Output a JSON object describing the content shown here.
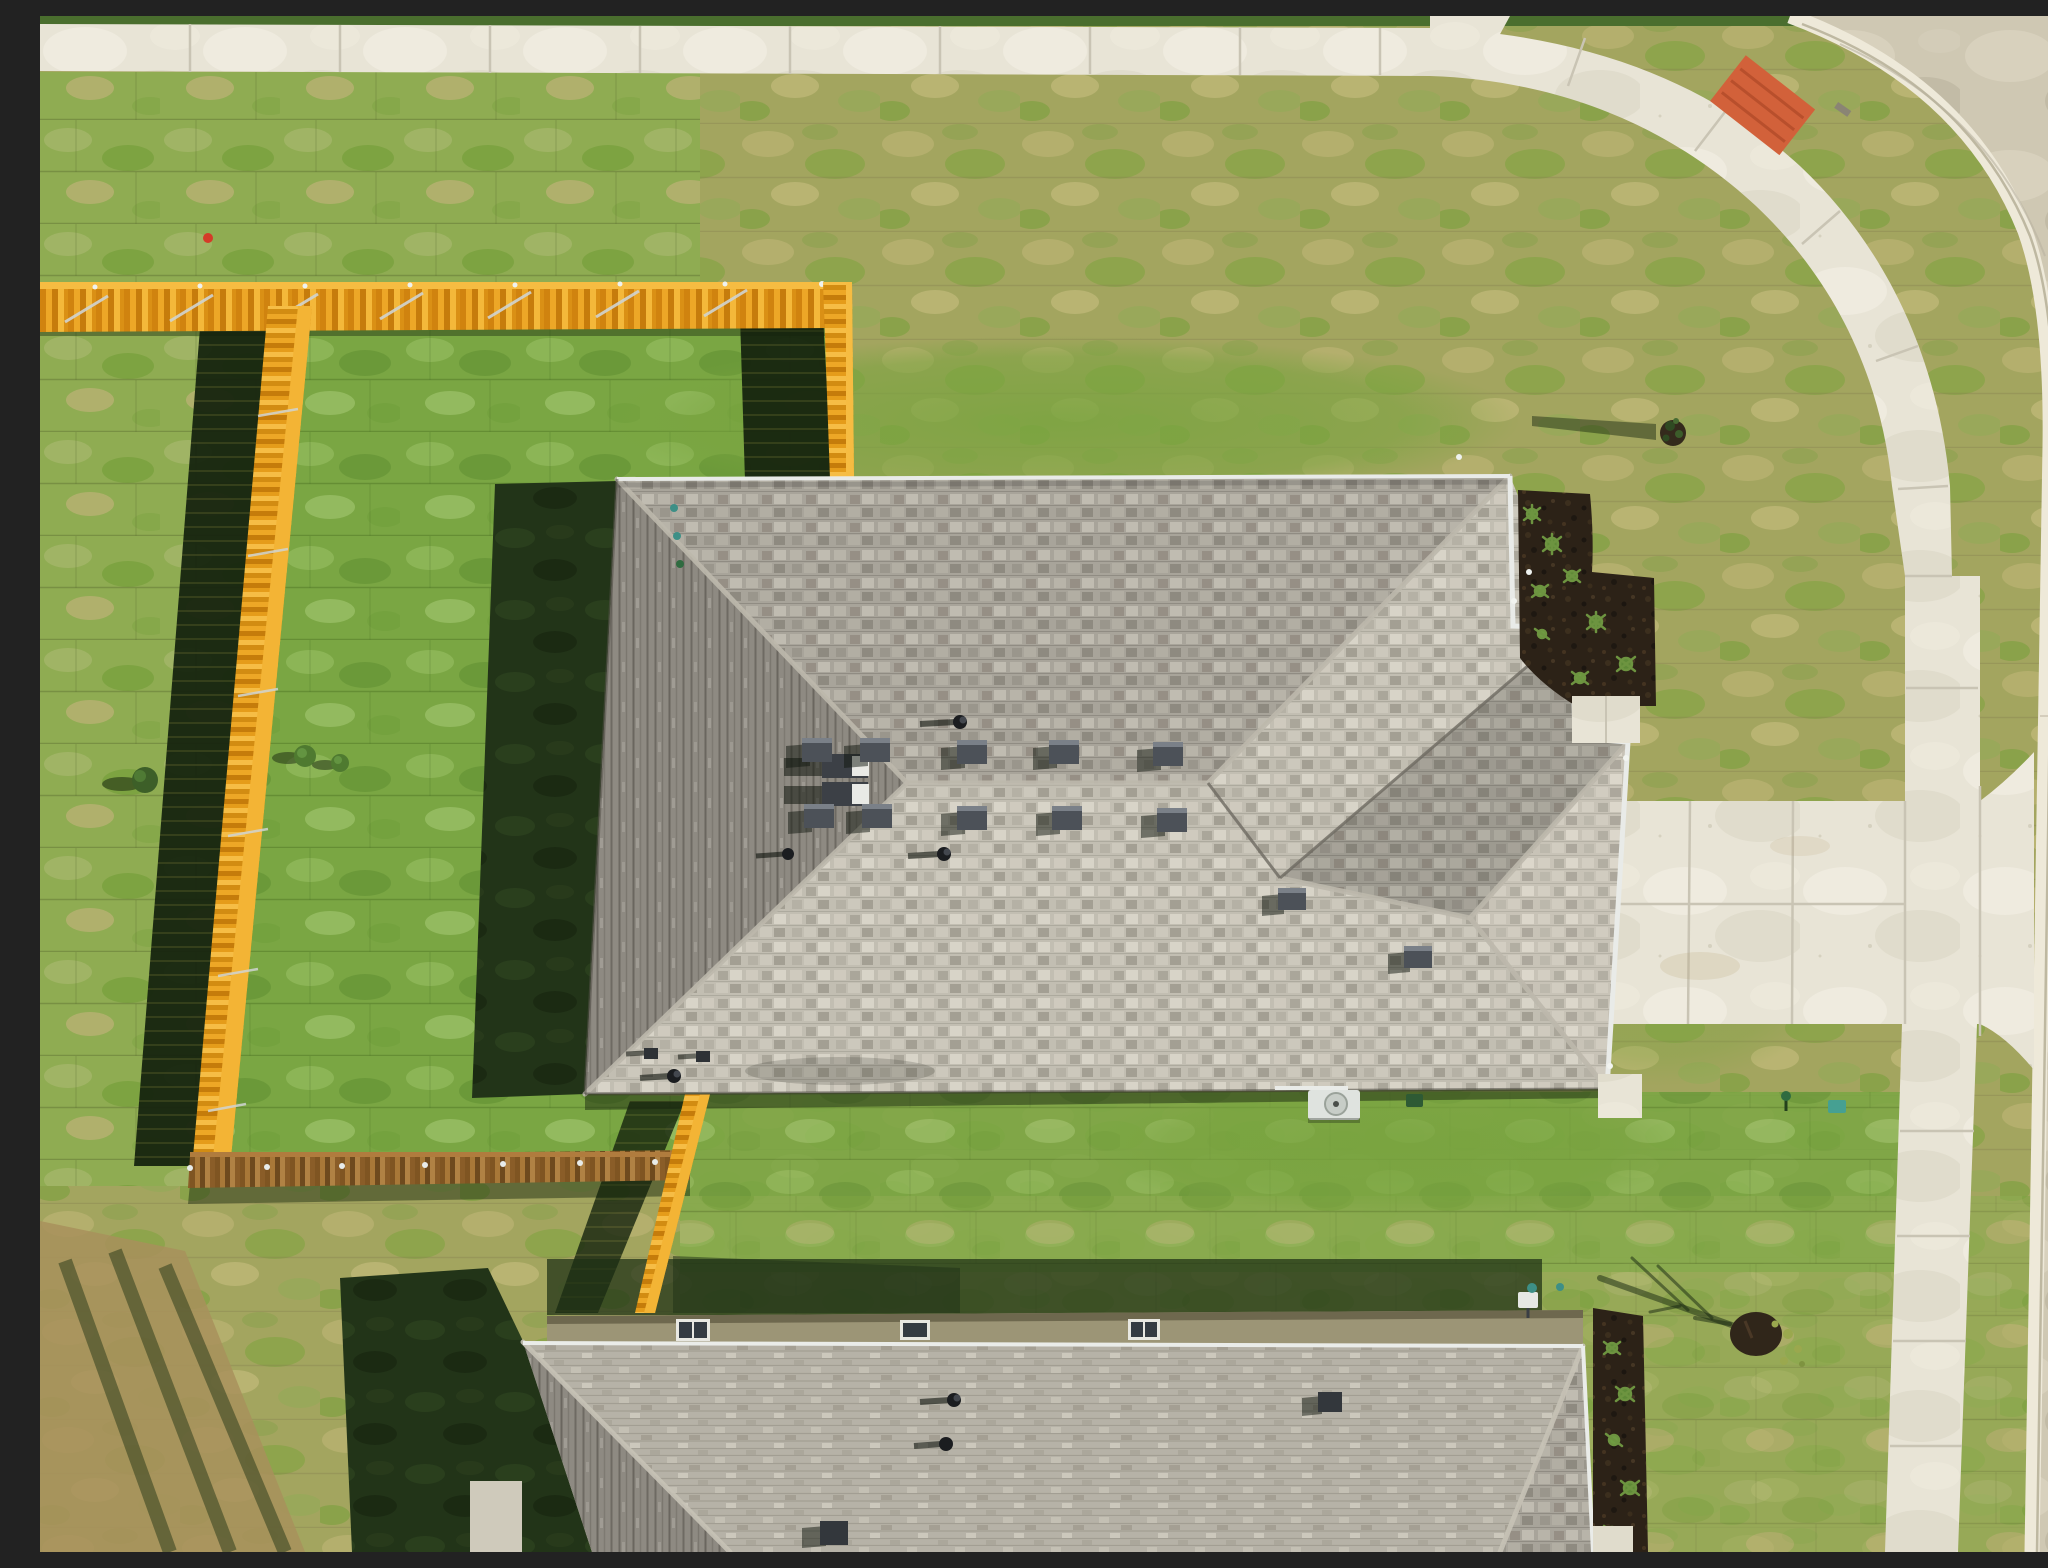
{
  "scene": {
    "title": "Aerial top-down drone photo of a new suburban house on a corner lot",
    "description": "Overhead nadir view: large gray hip-roof house centered, bright new yellow-orange wooden privacy fence enclosing the left backyard, fresh sod lawns, concrete sidewalks along top and right with curved street corner, side-entry concrete driveway, second house roof at bottom, long morning shadows cast to the west",
    "time_of_day": "morning, low sun from the east",
    "palette": {
      "grass_dry": "#a3a55f",
      "grass_lush": "#7aa643",
      "grass_mid": "#8fac52",
      "grass_shadow": "#223418",
      "roof_mid": "#a8a49a",
      "roof_light": "#c2beb2",
      "roof_dark_slope": "#8e8a82",
      "fence_orange": "#e8a31f",
      "fence_brown": "#96672e",
      "concrete": "#e8e4d6",
      "street": "#cfc8b3",
      "mulch": "#2c2217",
      "ada_mat_orange": "#d2613a",
      "ac_unit": "#dfe3df",
      "utility_teal": "#3d8f86",
      "marker_red": "#d43b28"
    },
    "objects": {
      "main_house_roof": {
        "shingles": "gray architectural",
        "ridge_vents_with_white_caps": 2,
        "square_attic_vents_row1": 5,
        "square_attic_vents_row2": 5,
        "extra_square_vents": 2,
        "pipe_vents": 6,
        "gutters": "white, along east stepped edges"
      },
      "fence": {
        "color": "new cedar stained yellow-orange",
        "runs": [
          "north run east-west",
          "vertical leg to house",
          "west property leg",
          "south brown run",
          "east leg to second house"
        ],
        "posts": "galvanized steel with diagonal braces"
      },
      "driveway": {
        "type": "side-entry double-wide concrete",
        "joints": "saw-cut grid",
        "connects": "east garage face to street"
      },
      "sidewalks": {
        "top": "straight east-west",
        "right": "north-south",
        "corner": "curved with orange ADA ramp mat"
      },
      "second_house": {
        "visible": "north wall band and gray roof at bottom edge",
        "windows_on_north_wall": 3,
        "electric_meter": 1
      },
      "landscaping": {
        "mulch_beds": 2,
        "ornamental_grass_tufts": "along east walls",
        "young_trees": 2,
        "shrubs_west_lawn": 3
      },
      "utilities": {
        "ac_condenser": 1,
        "green_utility_box": 1,
        "teal_irrigation_markers": 5,
        "red_marker_flag": 1
      }
    }
  }
}
